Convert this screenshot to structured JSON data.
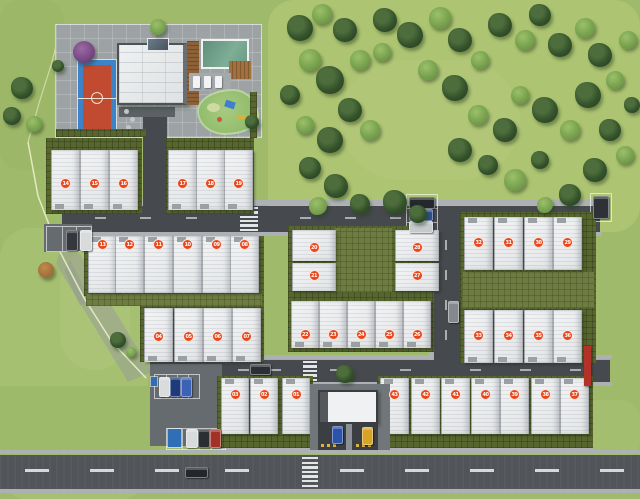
{
  "scene": {
    "width": 640,
    "height": 499,
    "description_units_visible": "numbered lot markers 01-43"
  },
  "palette": {
    "grass_base": "#9fba6a",
    "field_grass": "#aec573",
    "road": "#46494d",
    "street": "#51555a",
    "walkway": "#adb1b3",
    "hedge": "#57652f",
    "house_roof": "#edeff1",
    "marker": "#e8471c",
    "pool_water": "#6e9c85",
    "court_blue": "#3e82c8",
    "court_red": "#c04b30",
    "playground_green": "#93bd6d",
    "wood_brown": "#8c6138",
    "red_wall": "#b23227",
    "boundary_line": "#eef2cf"
  },
  "ground_patches": [
    {
      "x": 268,
      "y": 0,
      "w": 372,
      "h": 232,
      "color": "#aec573",
      "opacity": 0.95,
      "r": 26
    },
    {
      "x": 0,
      "y": 228,
      "w": 148,
      "h": 272,
      "color": "#a7c172",
      "opacity": 0.85,
      "r": 30
    },
    {
      "x": 0,
      "y": 0,
      "w": 64,
      "h": 170,
      "color": "#9cb768",
      "opacity": 0.9,
      "r": 20
    },
    {
      "x": 0,
      "y": 386,
      "w": 152,
      "h": 70,
      "color": "#9dba6b",
      "opacity": 1,
      "r": 0
    },
    {
      "x": 340,
      "y": 60,
      "w": 180,
      "h": 120,
      "color": "#b5ca7c",
      "opacity": 0.5,
      "r": 60
    },
    {
      "x": 60,
      "y": 250,
      "w": 70,
      "h": 120,
      "color": "#b2c77e",
      "opacity": 0.45,
      "r": 40
    },
    {
      "x": 500,
      "y": 400,
      "w": 140,
      "h": 60,
      "color": "#a4bf70",
      "opacity": 0.8,
      "r": 20
    }
  ],
  "walkways": [
    {
      "x": 60,
      "y": 200,
      "w": 542,
      "h": 5
    },
    {
      "x": 62,
      "y": 232,
      "w": 540,
      "h": 4
    },
    {
      "x": 148,
      "y": 355,
      "w": 464,
      "h": 4
    },
    {
      "x": 150,
      "y": 382,
      "w": 462,
      "h": 4
    },
    {
      "x": 429,
      "y": 206,
      "w": 4,
      "h": 176
    },
    {
      "x": 582,
      "y": 214,
      "w": 4,
      "h": 146
    },
    {
      "x": 0,
      "y": 450,
      "w": 640,
      "h": 4
    },
    {
      "x": 0,
      "y": 489,
      "w": 640,
      "h": 4
    },
    {
      "x": 217,
      "y": 446,
      "w": 96,
      "h": 4
    },
    {
      "x": 377,
      "y": 446,
      "w": 216,
      "h": 4
    },
    {
      "x": 286,
      "y": 386,
      "w": 106,
      "h": 5
    }
  ],
  "roads": [
    {
      "x": 62,
      "y": 206,
      "w": 538,
      "h": 26,
      "kind": "road"
    },
    {
      "x": 434,
      "y": 206,
      "w": 26,
      "h": 176,
      "kind": "road"
    },
    {
      "x": 150,
      "y": 360,
      "w": 460,
      "h": 22,
      "kind": "road"
    },
    {
      "x": 0,
      "y": 455,
      "w": 640,
      "h": 34,
      "kind": "street"
    }
  ],
  "parking_lots": [
    {
      "x": 44,
      "y": 224,
      "w": 48,
      "h": 28
    },
    {
      "x": 150,
      "y": 364,
      "w": 72,
      "h": 82
    }
  ],
  "parking_stalls": [
    {
      "x": 46,
      "y": 226,
      "w": 44,
      "h": 24,
      "lines": 2
    },
    {
      "x": 406,
      "y": 194,
      "w": 30,
      "h": 40,
      "lines": 2,
      "horizontal": true
    },
    {
      "x": 590,
      "y": 193,
      "w": 20,
      "h": 27,
      "lines": 0
    },
    {
      "x": 154,
      "y": 374,
      "w": 44,
      "h": 23,
      "lines": 3
    },
    {
      "x": 166,
      "y": 428,
      "w": 58,
      "h": 20,
      "lines": 3
    }
  ],
  "road_dashes": [
    {
      "x": 95,
      "y": 217,
      "w": 11,
      "h": 2
    },
    {
      "x": 140,
      "y": 217,
      "w": 11,
      "h": 2
    },
    {
      "x": 186,
      "y": 217,
      "w": 11,
      "h": 2
    },
    {
      "x": 300,
      "y": 217,
      "w": 11,
      "h": 2
    },
    {
      "x": 345,
      "y": 217,
      "w": 11,
      "h": 2
    },
    {
      "x": 390,
      "y": 217,
      "w": 11,
      "h": 2
    },
    {
      "x": 480,
      "y": 217,
      "w": 11,
      "h": 2
    },
    {
      "x": 525,
      "y": 217,
      "w": 11,
      "h": 2
    },
    {
      "x": 570,
      "y": 217,
      "w": 11,
      "h": 2
    },
    {
      "x": 238,
      "y": 369,
      "w": 11,
      "h": 2
    },
    {
      "x": 270,
      "y": 369,
      "w": 11,
      "h": 2
    },
    {
      "x": 330,
      "y": 369,
      "w": 11,
      "h": 2
    },
    {
      "x": 400,
      "y": 369,
      "w": 11,
      "h": 2
    },
    {
      "x": 470,
      "y": 369,
      "w": 11,
      "h": 2
    },
    {
      "x": 520,
      "y": 369,
      "w": 11,
      "h": 2
    },
    {
      "x": 570,
      "y": 369,
      "w": 11,
      "h": 2
    },
    {
      "x": 445,
      "y": 240,
      "w": 2,
      "h": 10
    },
    {
      "x": 445,
      "y": 270,
      "w": 2,
      "h": 10
    },
    {
      "x": 445,
      "y": 300,
      "w": 2,
      "h": 10
    },
    {
      "x": 445,
      "y": 330,
      "w": 2,
      "h": 10
    },
    {
      "x": 25,
      "y": 469,
      "w": 24,
      "h": 3,
      "bright": true
    },
    {
      "x": 90,
      "y": 469,
      "w": 24,
      "h": 3,
      "bright": true
    },
    {
      "x": 155,
      "y": 469,
      "w": 24,
      "h": 3,
      "bright": true
    },
    {
      "x": 225,
      "y": 469,
      "w": 24,
      "h": 3,
      "bright": true
    },
    {
      "x": 340,
      "y": 469,
      "w": 24,
      "h": 3,
      "bright": true
    },
    {
      "x": 405,
      "y": 469,
      "w": 24,
      "h": 3,
      "bright": true
    },
    {
      "x": 470,
      "y": 469,
      "w": 24,
      "h": 3,
      "bright": true
    },
    {
      "x": 535,
      "y": 469,
      "w": 24,
      "h": 3,
      "bright": true
    },
    {
      "x": 600,
      "y": 469,
      "w": 24,
      "h": 3,
      "bright": true
    }
  ],
  "crosswalks": [
    {
      "x": 240,
      "y": 207,
      "w": 18,
      "h": 24,
      "bars": 6
    },
    {
      "x": 303,
      "y": 361,
      "w": 14,
      "h": 20,
      "bars": 5
    },
    {
      "x": 302,
      "y": 457,
      "w": 16,
      "h": 30,
      "bars": 7
    }
  ],
  "features": [
    {
      "type": "disabled-parking-stall",
      "x": 168,
      "y": 429,
      "w": 13,
      "h": 18,
      "color": "#2f6fb5"
    },
    {
      "type": "parking-sign",
      "x": 151,
      "y": 377,
      "w": 6,
      "h": 9,
      "color": "#2f6fb5"
    }
  ],
  "features_over": [
    {
      "type": "red-feature-wall",
      "x": 584,
      "y": 346,
      "w": 7,
      "h": 40,
      "color": "#b23227"
    }
  ],
  "hedges": [
    {
      "x": 46,
      "y": 138,
      "w": 96,
      "h": 76
    },
    {
      "x": 166,
      "y": 138,
      "w": 88,
      "h": 76
    },
    {
      "x": 84,
      "y": 236,
      "w": 180,
      "h": 60
    },
    {
      "x": 140,
      "y": 296,
      "w": 124,
      "h": 66
    },
    {
      "x": 217,
      "y": 376,
      "w": 96,
      "h": 72
    },
    {
      "x": 288,
      "y": 226,
      "w": 146,
      "h": 126
    },
    {
      "x": 460,
      "y": 212,
      "w": 136,
      "h": 152
    },
    {
      "x": 377,
      "y": 376,
      "w": 216,
      "h": 72
    },
    {
      "x": 56,
      "y": 129,
      "w": 90,
      "h": 8
    },
    {
      "x": 250,
      "y": 92,
      "w": 7,
      "h": 46
    }
  ],
  "hedge_overlays": [
    {
      "x": 334,
      "y": 228,
      "w": 58,
      "h": 64
    },
    {
      "x": 462,
      "y": 272,
      "w": 132,
      "h": 36
    },
    {
      "x": 86,
      "y": 294,
      "w": 176,
      "h": 12
    }
  ],
  "unit_rows": [
    {
      "name": "row-a-west",
      "y": 150,
      "h": 60,
      "w": 27,
      "front": "bottom",
      "mdy": 33,
      "houses": [
        {
          "num": "14",
          "x": 51
        },
        {
          "num": "15",
          "x": 80
        },
        {
          "num": "16",
          "x": 109
        }
      ]
    },
    {
      "name": "row-a-east",
      "y": 150,
      "h": 60,
      "w": 27,
      "front": "bottom",
      "mdy": 33,
      "houses": [
        {
          "num": "17",
          "x": 168
        },
        {
          "num": "18",
          "x": 196
        },
        {
          "num": "19",
          "x": 224
        }
      ]
    },
    {
      "name": "row-b",
      "y": 236,
      "h": 57,
      "w": 27,
      "front": "top",
      "mdy": 8,
      "houses": [
        {
          "num": "13",
          "x": 88
        },
        {
          "num": "12",
          "x": 115
        },
        {
          "num": "11",
          "x": 144
        },
        {
          "num": "10",
          "x": 173
        },
        {
          "num": "09",
          "x": 202
        },
        {
          "num": "08",
          "x": 230
        }
      ]
    },
    {
      "name": "row-c",
      "y": 308,
      "h": 54,
      "w": 27,
      "front": "bottom",
      "mdy": 28,
      "houses": [
        {
          "num": "04",
          "x": 144
        },
        {
          "num": "05",
          "x": 174
        },
        {
          "num": "06",
          "x": 203
        },
        {
          "num": "07",
          "x": 232
        }
      ]
    },
    {
      "name": "row-d",
      "y": 378,
      "h": 56,
      "w": 26,
      "front": "top",
      "mdy": 16,
      "houses": [
        {
          "num": "03",
          "x": 221
        },
        {
          "num": "02",
          "x": 250
        },
        {
          "num": "01",
          "x": 282
        }
      ]
    },
    {
      "name": "mid-west-col",
      "y": 230,
      "h": 31,
      "w": 42,
      "front": "none",
      "mdy": 17,
      "houses": [
        {
          "num": "20",
          "x": 292
        },
        {
          "num": "21",
          "x": 292,
          "y": 263,
          "h": 28,
          "mdy": 12
        }
      ]
    },
    {
      "name": "mid-east-col",
      "y": 230,
      "h": 31,
      "w": 42,
      "front": "none",
      "mdy": 17,
      "houses": [
        {
          "num": "28",
          "x": 395
        },
        {
          "num": "27",
          "x": 395,
          "y": 263,
          "h": 28,
          "mdy": 12
        }
      ]
    },
    {
      "name": "mid-south",
      "y": 301,
      "h": 47,
      "w": 26,
      "front": "bottom",
      "mdy": 33,
      "houses": [
        {
          "num": "22",
          "x": 291
        },
        {
          "num": "23",
          "x": 319
        },
        {
          "num": "24",
          "x": 347
        },
        {
          "num": "25",
          "x": 375
        },
        {
          "num": "26",
          "x": 403
        }
      ]
    },
    {
      "name": "right-north",
      "y": 217,
      "h": 53,
      "w": 27,
      "front": "top",
      "mdy": 25,
      "houses": [
        {
          "num": "32",
          "x": 464
        },
        {
          "num": "31",
          "x": 494
        },
        {
          "num": "30",
          "x": 524
        },
        {
          "num": "29",
          "x": 553
        }
      ]
    },
    {
      "name": "right-south",
      "y": 310,
      "h": 53,
      "w": 27,
      "front": "bottom",
      "mdy": 25,
      "houses": [
        {
          "num": "33",
          "x": 464
        },
        {
          "num": "34",
          "x": 494
        },
        {
          "num": "35",
          "x": 524
        },
        {
          "num": "36",
          "x": 553
        }
      ]
    },
    {
      "name": "row-s-east",
      "y": 378,
      "h": 56,
      "w": 27,
      "front": "top",
      "mdy": 16,
      "houses": [
        {
          "num": "43",
          "x": 380
        },
        {
          "num": "42",
          "x": 411
        },
        {
          "num": "41",
          "x": 441
        },
        {
          "num": "40",
          "x": 471
        },
        {
          "num": "39",
          "x": 500
        },
        {
          "num": "38",
          "x": 531
        },
        {
          "num": "37",
          "x": 560
        }
      ]
    }
  ],
  "cars": [
    {
      "x": 66,
      "y": 230,
      "w": 10,
      "h": 19,
      "color": "#34383e"
    },
    {
      "x": 80,
      "y": 230,
      "w": 10,
      "h": 19,
      "color": "#d8dadc"
    },
    {
      "x": 409,
      "y": 197,
      "w": 24,
      "h": 10,
      "color": "#24282d"
    },
    {
      "x": 409,
      "y": 209,
      "w": 22,
      "h": 10,
      "color": "#2d4f93"
    },
    {
      "x": 409,
      "y": 221,
      "w": 22,
      "h": 10,
      "color": "#c6cacd"
    },
    {
      "x": 593,
      "y": 196,
      "w": 14,
      "h": 21,
      "color": "#2e3237"
    },
    {
      "x": 448,
      "y": 301,
      "w": 9,
      "h": 20,
      "color": "#85898e"
    },
    {
      "x": 159,
      "y": 377,
      "w": 9,
      "h": 18,
      "color": "#d9dbdc"
    },
    {
      "x": 170,
      "y": 377,
      "w": 9,
      "h": 18,
      "color": "#1f3a7a"
    },
    {
      "x": 181,
      "y": 377,
      "w": 9,
      "h": 18,
      "color": "#3b62b5"
    },
    {
      "x": 186,
      "y": 429,
      "w": 10,
      "h": 17,
      "color": "#d8dadb"
    },
    {
      "x": 198,
      "y": 429,
      "w": 10,
      "h": 17,
      "color": "#2b2f34"
    },
    {
      "x": 210,
      "y": 429,
      "w": 9,
      "h": 17,
      "color": "#a33226"
    },
    {
      "x": 332,
      "y": 426,
      "w": 9,
      "h": 16,
      "color": "#2b53a8"
    },
    {
      "x": 362,
      "y": 427,
      "w": 9,
      "h": 16,
      "color": "#d8a427"
    },
    {
      "x": 185,
      "y": 467,
      "w": 21,
      "h": 9,
      "color": "#23272b"
    },
    {
      "x": 250,
      "y": 364,
      "w": 19,
      "h": 9,
      "color": "#2c3036"
    }
  ],
  "trees": [
    {
      "x": 300,
      "y": 28,
      "r": 13,
      "v": "d"
    },
    {
      "x": 322,
      "y": 14,
      "r": 10,
      "v": "l"
    },
    {
      "x": 345,
      "y": 30,
      "r": 12,
      "v": "d"
    },
    {
      "x": 310,
      "y": 60,
      "r": 11,
      "v": "l"
    },
    {
      "x": 290,
      "y": 95,
      "r": 10,
      "v": "d"
    },
    {
      "x": 330,
      "y": 80,
      "r": 14,
      "v": "d"
    },
    {
      "x": 360,
      "y": 60,
      "r": 10,
      "v": "l"
    },
    {
      "x": 385,
      "y": 20,
      "r": 12,
      "v": "d"
    },
    {
      "x": 382,
      "y": 52,
      "r": 9,
      "v": "l"
    },
    {
      "x": 410,
      "y": 35,
      "r": 13,
      "v": "d"
    },
    {
      "x": 440,
      "y": 18,
      "r": 11,
      "v": "l"
    },
    {
      "x": 460,
      "y": 40,
      "r": 12,
      "v": "d"
    },
    {
      "x": 428,
      "y": 70,
      "r": 10,
      "v": "l"
    },
    {
      "x": 455,
      "y": 88,
      "r": 13,
      "v": "d"
    },
    {
      "x": 480,
      "y": 60,
      "r": 9,
      "v": "l"
    },
    {
      "x": 500,
      "y": 25,
      "r": 12,
      "v": "d"
    },
    {
      "x": 525,
      "y": 40,
      "r": 10,
      "v": "l"
    },
    {
      "x": 540,
      "y": 15,
      "r": 11,
      "v": "d"
    },
    {
      "x": 560,
      "y": 45,
      "r": 12,
      "v": "d"
    },
    {
      "x": 585,
      "y": 28,
      "r": 10,
      "v": "l"
    },
    {
      "x": 600,
      "y": 55,
      "r": 12,
      "v": "d"
    },
    {
      "x": 615,
      "y": 80,
      "r": 9,
      "v": "l"
    },
    {
      "x": 588,
      "y": 95,
      "r": 13,
      "v": "d"
    },
    {
      "x": 610,
      "y": 130,
      "r": 11,
      "v": "d"
    },
    {
      "x": 625,
      "y": 155,
      "r": 9,
      "v": "l"
    },
    {
      "x": 595,
      "y": 170,
      "r": 12,
      "v": "d"
    },
    {
      "x": 570,
      "y": 130,
      "r": 10,
      "v": "l"
    },
    {
      "x": 545,
      "y": 110,
      "r": 13,
      "v": "d"
    },
    {
      "x": 520,
      "y": 95,
      "r": 9,
      "v": "l"
    },
    {
      "x": 505,
      "y": 130,
      "r": 12,
      "v": "d"
    },
    {
      "x": 478,
      "y": 115,
      "r": 10,
      "v": "l"
    },
    {
      "x": 460,
      "y": 150,
      "r": 12,
      "v": "d"
    },
    {
      "x": 488,
      "y": 165,
      "r": 10,
      "v": "d"
    },
    {
      "x": 515,
      "y": 180,
      "r": 11,
      "v": "l"
    },
    {
      "x": 540,
      "y": 160,
      "r": 9,
      "v": "d"
    },
    {
      "x": 350,
      "y": 110,
      "r": 12,
      "v": "d"
    },
    {
      "x": 370,
      "y": 130,
      "r": 10,
      "v": "l"
    },
    {
      "x": 330,
      "y": 140,
      "r": 13,
      "v": "d"
    },
    {
      "x": 305,
      "y": 125,
      "r": 9,
      "v": "l"
    },
    {
      "x": 310,
      "y": 168,
      "r": 11,
      "v": "d"
    },
    {
      "x": 336,
      "y": 186,
      "r": 12,
      "v": "d"
    },
    {
      "x": 318,
      "y": 206,
      "r": 9,
      "v": "l"
    },
    {
      "x": 360,
      "y": 204,
      "r": 10,
      "v": "d"
    },
    {
      "x": 395,
      "y": 202,
      "r": 12,
      "v": "d"
    },
    {
      "x": 418,
      "y": 214,
      "r": 9,
      "v": "d"
    },
    {
      "x": 570,
      "y": 195,
      "r": 11,
      "v": "d"
    },
    {
      "x": 545,
      "y": 205,
      "r": 8,
      "v": "l"
    },
    {
      "x": 22,
      "y": 88,
      "r": 11,
      "v": "d"
    },
    {
      "x": 12,
      "y": 116,
      "r": 9,
      "v": "d"
    },
    {
      "x": 34,
      "y": 124,
      "r": 8,
      "v": "l"
    },
    {
      "x": 118,
      "y": 340,
      "r": 8,
      "v": "d"
    },
    {
      "x": 131,
      "y": 352,
      "r": 5,
      "v": "l"
    },
    {
      "x": 46,
      "y": 270,
      "r": 8,
      "v": "a"
    },
    {
      "x": 84,
      "y": 52,
      "r": 11,
      "v": "p"
    },
    {
      "x": 58,
      "y": 66,
      "r": 6,
      "v": "d"
    },
    {
      "x": 158,
      "y": 27,
      "r": 8,
      "v": "l"
    },
    {
      "x": 252,
      "y": 122,
      "r": 7,
      "v": "d"
    },
    {
      "x": 345,
      "y": 374,
      "r": 9,
      "v": "d"
    },
    {
      "x": 628,
      "y": 40,
      "r": 9,
      "v": "l"
    },
    {
      "x": 632,
      "y": 105,
      "r": 8,
      "v": "d"
    }
  ]
}
